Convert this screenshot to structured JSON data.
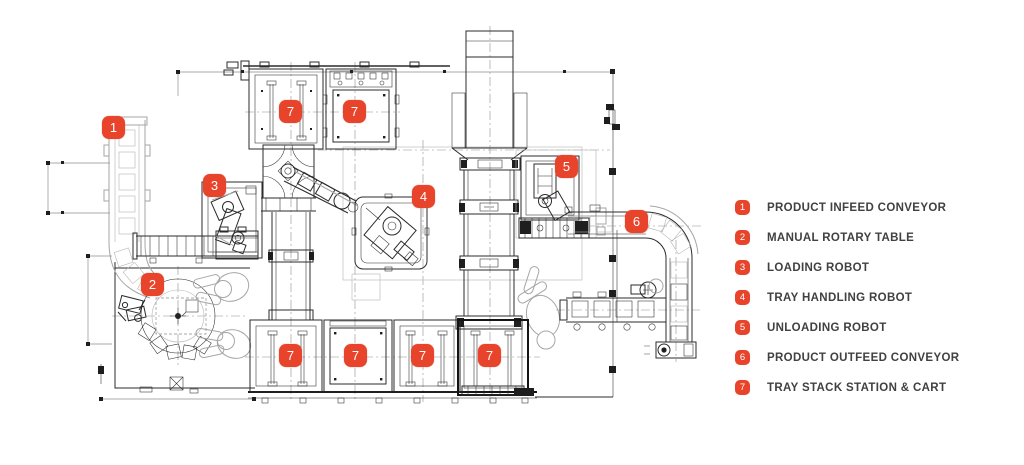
{
  "colors": {
    "accent": "#E8432B",
    "text": "#414042"
  },
  "diagram": {
    "type": "cad-floor-plan",
    "description": "Top view plan of automated tray loading cell",
    "markers": [
      "1",
      "2",
      "3",
      "4",
      "5",
      "6",
      "7",
      "7",
      "7",
      "7",
      "7",
      "7"
    ]
  },
  "legend": {
    "items": [
      {
        "num": "1",
        "label": "PRODUCT INFEED CONVEYOR"
      },
      {
        "num": "2",
        "label": "MANUAL ROTARY TABLE"
      },
      {
        "num": "3",
        "label": "LOADING ROBOT"
      },
      {
        "num": "4",
        "label": "TRAY HANDLING ROBOT"
      },
      {
        "num": "5",
        "label": "UNLOADING ROBOT"
      },
      {
        "num": "6",
        "label": "PRODUCT OUTFEED CONVEYOR"
      },
      {
        "num": "7",
        "label": "TRAY STACK STATION & CART"
      }
    ]
  }
}
